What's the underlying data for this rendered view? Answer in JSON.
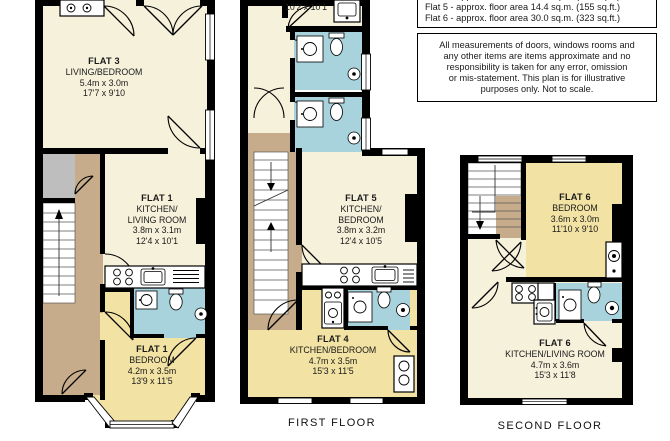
{
  "info_box": {
    "area_lines": {
      "clipped": "Flat 4 - approx. floor area 16.4 sq.m. (177 sq.ft.)",
      "flat5": "Flat 5 - approx. floor area 14.4 sq.m. (155 sq.ft.)",
      "flat6": "Flat 6 - approx. floor area 30.0 sq.m. (323 sq.ft.)"
    },
    "disclaimer_lines": [
      "All measurements of doors, windows rooms and",
      "any other items are items approximate and no",
      "responsibility is taken for any error, omission",
      "or mis-statement. This plan is for illustrative",
      "purposes only. Not to scale."
    ]
  },
  "ground_floor": {
    "flat3": [
      "FLAT 3",
      "LIVING/BEDROOM",
      "5.4m x 3.0m",
      "17'7 x 9'10"
    ],
    "flat1_kitchen": [
      "FLAT 1",
      "KITCHEN/",
      "LIVING ROOM",
      "3.8m x 3.1m",
      "12'4 x 10'1"
    ],
    "flat1_bedroom": [
      "FLAT 1",
      "BEDROOM",
      "4.2m x 3.5m",
      "13'9 x 11'5"
    ]
  },
  "first_floor": {
    "label": "FIRST FLOOR",
    "partial_room_dims": "10'2 x 10'1",
    "flat5": [
      "FLAT 5",
      "KITCHEN/",
      "BEDROOM",
      "3.8m x 3.2m",
      "12'4 x 10'5"
    ],
    "flat4": [
      "FLAT 4",
      "KITCHEN/BEDROOM",
      "4.7m x 3.5m",
      "15'3 x 11'5"
    ]
  },
  "second_floor": {
    "label": "SECOND FLOOR",
    "flat6_bedroom": [
      "FLAT 6",
      "BEDROOM",
      "3.6m x 3.0m",
      "11'10 x 9'10"
    ],
    "flat6_living": [
      "FLAT 6",
      "KITCHEN/LIVING ROOM",
      "4.7m x 3.6m",
      "15'3 x 11'8"
    ]
  },
  "colors": {
    "room_cream": "#F6F1DB",
    "room_yellow": "#F2E3A4",
    "bathroom_blue": "#A8D3DD",
    "hallway_tan": "#C6AC8A",
    "closet_gray": "#BEBEBE",
    "wall_black": "#000000"
  }
}
